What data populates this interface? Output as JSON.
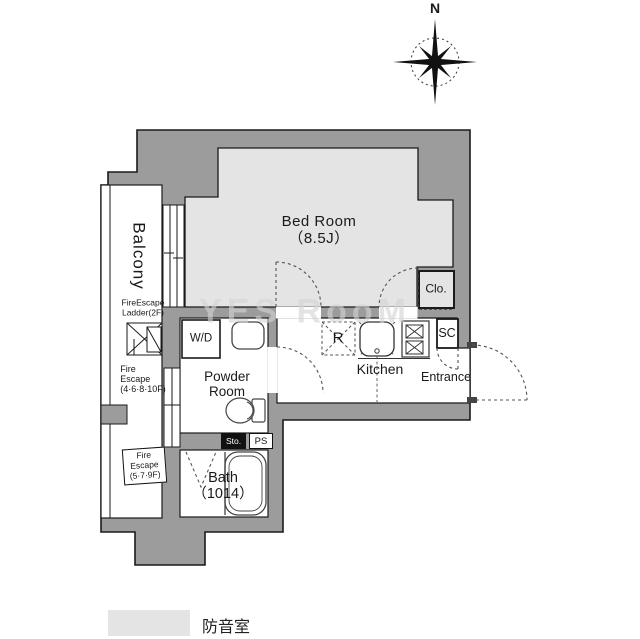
{
  "compass": {
    "label": "N"
  },
  "rooms": {
    "balcony": "Balcony",
    "bedroom": "Bed Room\n（8.5J）",
    "powder_room": "Powder\nRoom",
    "bath": "Bath\n（1014）",
    "kitchen": "Kitchen",
    "entrance": "Entrance",
    "wd": "W/D",
    "refrigerator": "R",
    "closet": "Clo.",
    "shoe_closet": "SC",
    "storage": "Sto.",
    "pipe_space": "PS"
  },
  "fire_escape": {
    "ladder": "FireEscape\nLadder(2F)",
    "upper_floors": "Fire\nEscape\n(4·6·8·10F)",
    "lower_floors": "Fire\nEscape\n(5·7·9F)"
  },
  "legend": {
    "label": "防音室",
    "swatch_color": "#e4e4e4"
  },
  "watermark": "YES RooM",
  "colors": {
    "wall": "#9c9c9c",
    "soundproof_fill": "#e4e4e4",
    "line": "#1a1a1a",
    "dash": "#555555"
  }
}
